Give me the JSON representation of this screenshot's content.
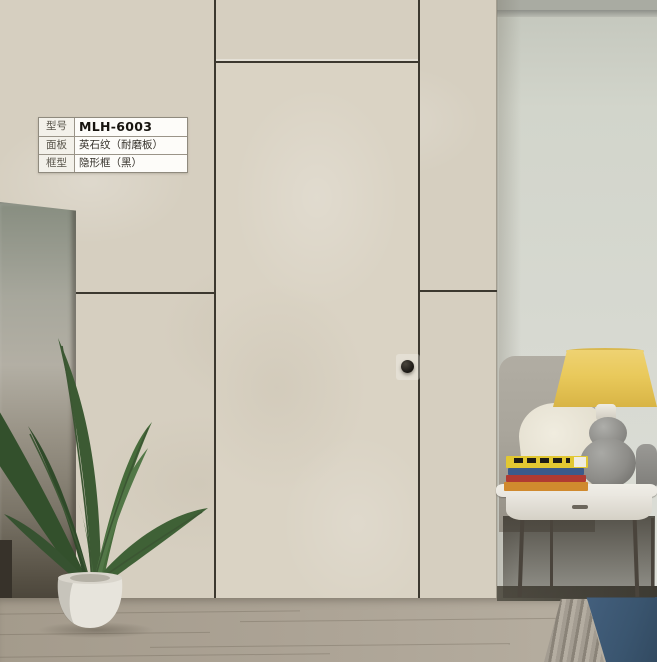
{
  "spec_table": {
    "rows": [
      {
        "label": "型号",
        "value": "MLH-6003"
      },
      {
        "label": "面板",
        "value": "英石纹（耐磨板）"
      },
      {
        "label": "框型",
        "value": "隐形框（黑）"
      }
    ]
  },
  "colors": {
    "wall_panel": "#d6cfc0",
    "door_panel": "#dad3c4",
    "groove_line": "#3c382f",
    "side_wall": "#d5d7ce",
    "floor_wood": "#aba293",
    "rug_blue": "#44607e",
    "rug_fringe": "#9b948a",
    "lamp_shade": "#e9c95b",
    "lamp_base": "#8d8c88",
    "sofa_gray": "#a9a59b",
    "pillow_white": "#e8e4d6",
    "table_white": "#e9e6df",
    "table_leg": "#4a443c",
    "book_yellow": "#e2c832",
    "book_blue": "#3c5a8a",
    "book_red": "#b03a31",
    "book_orange": "#d08a2e",
    "plant_green": "#3f5e35",
    "pot_white": "#e6e3da",
    "knob_black": "#1d1a16"
  }
}
